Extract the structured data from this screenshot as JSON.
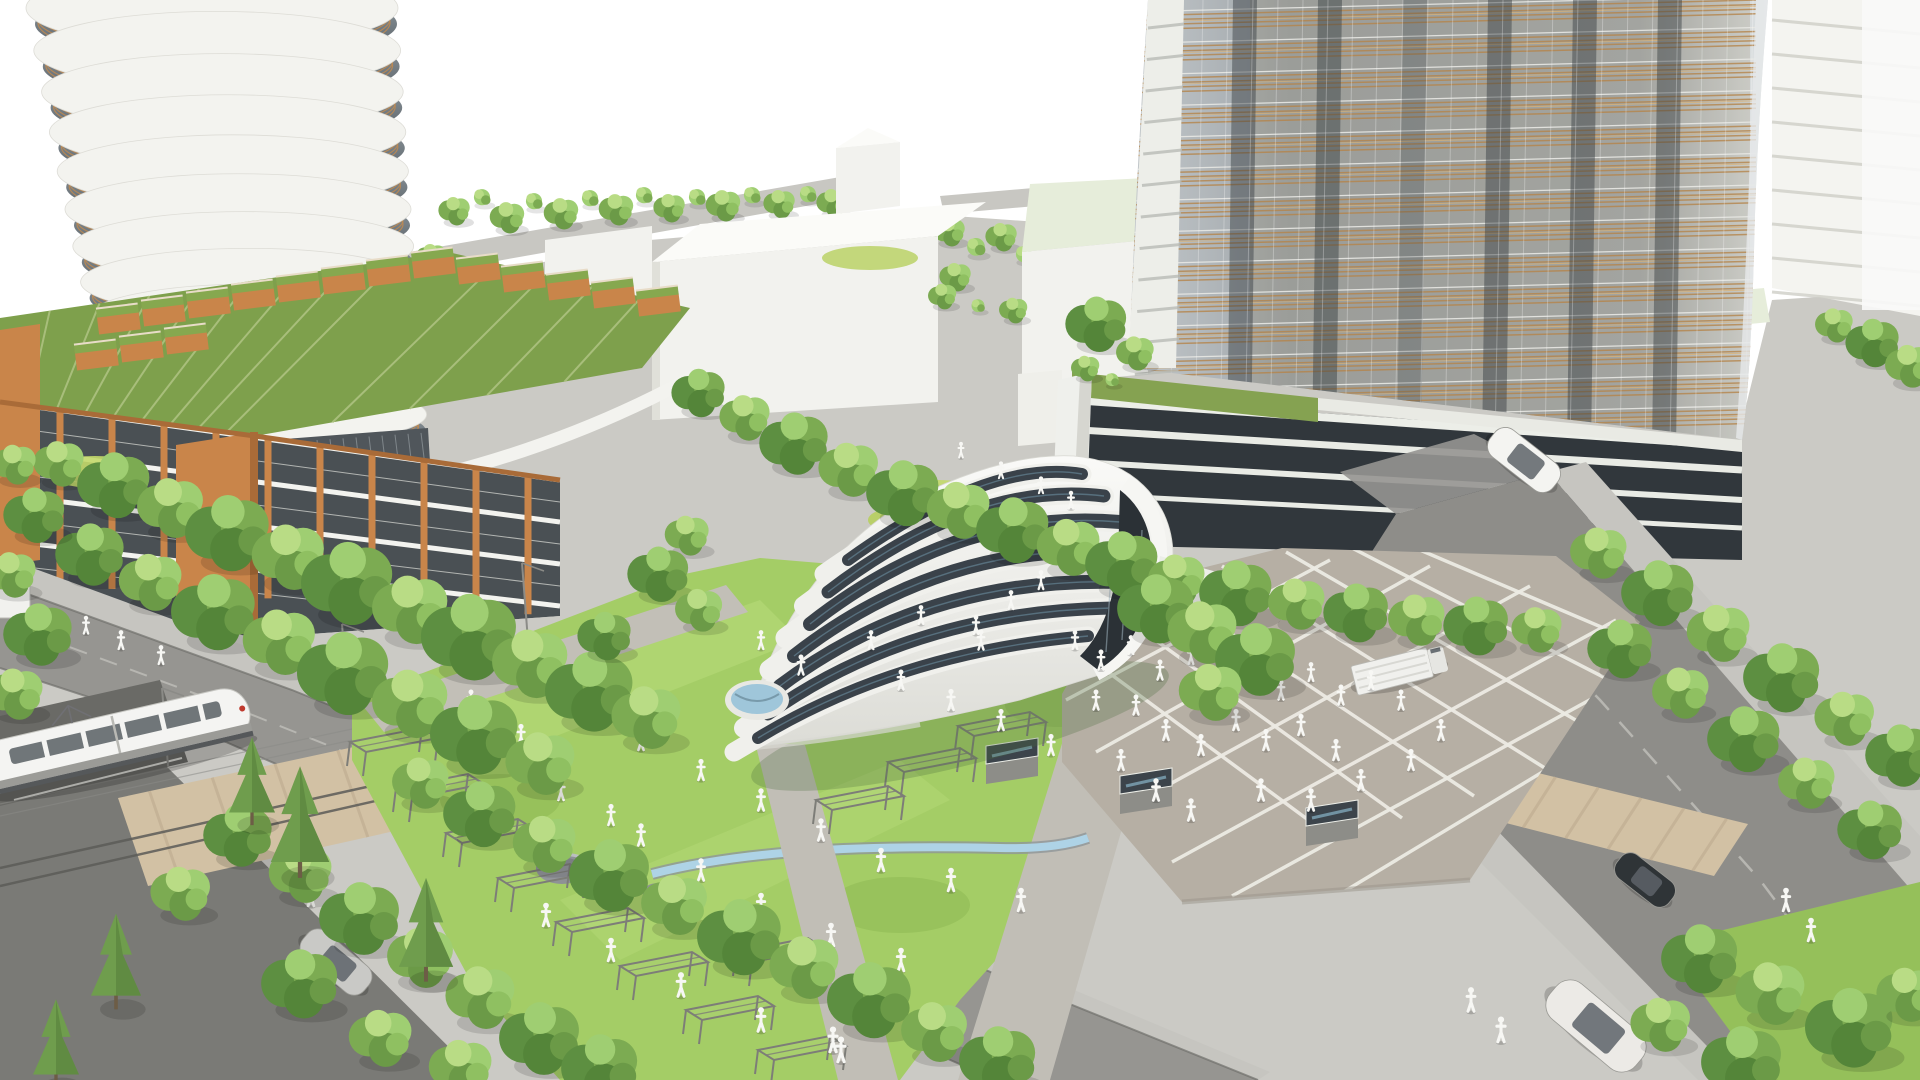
{
  "palette": {
    "bg": "#ffffff",
    "ground": "#cbcac5",
    "sidewalk": "#c6c5c0",
    "road": "#969591",
    "road_dark": "#7a7a76",
    "curb": "#6f6f6b",
    "tan": "#d2c1a4",
    "tan2": "#c2b094",
    "plaza": "#b6afa4",
    "grid": "#edebe4",
    "lawn": "#a4cd66",
    "lawn_light": "#b8dc7a",
    "lawn_dark": "#8ab550",
    "lawn_low": "#95c05a",
    "tree1": "#9fce72",
    "tree2": "#7cab52",
    "tree3": "#5d8f41",
    "tree4": "#b9dc85",
    "conifer": "#6f9d4d",
    "conifer_dark": "#567f3c",
    "trunk": "#7a6a52",
    "shell": "#f4f4f1",
    "shell_shade": "#d9d9d3",
    "panel": "#3a424a",
    "panel_lt": "#6f95a8",
    "arch_dark": "#2b3136",
    "pool": "#9fc6da",
    "water": "#aed3e6",
    "glassL1": "#9aa3a9",
    "glassL2": "#525a60",
    "slab": "#f3f3ef",
    "copper": "#c08a50",
    "terra": "#c9854a",
    "terra_dark": "#a96b38",
    "roofgreen": "#7ea04c",
    "roofseam": "#b3c687",
    "white_bldg": "#f2f2ee",
    "white_top": "#fbfbf8",
    "white_shade": "#e0e0d9",
    "slabline": "#cfcfc8",
    "towerR1": "#b7bcc0",
    "towerR2": "#9aa0a4",
    "louver": "#b5854b",
    "louver_lt": "#dcb273",
    "stripe_dark": "#343a3e",
    "podium_glass": "#31373c",
    "podium_stripe": "#e9ebe5",
    "pale_roof": "#e6edda",
    "fig": "#f7f7f4",
    "wire": "#8b8b87",
    "steel": "#7d7d78",
    "rock": "#8e9196",
    "train_body": "#f4f4f2",
    "train_win": "#646a6f",
    "skylight": "#3c444b",
    "sky_glint": "#7fa6b8",
    "corridor": "#b2b6b4",
    "facade_glass": "#4a5054",
    "terrace": "#85a251",
    "red": "#c03a2e"
  },
  "scene": {
    "left_tower": {
      "floors": 12,
      "cx0": 212,
      "dx": 5.2,
      "cy0": 8,
      "dy": 43,
      "sag": 0.55,
      "rx0": 186,
      "drx": 2.6,
      "ry0": 40,
      "dry": 0.9,
      "rails": 3,
      "mullions": 9
    },
    "right_tower": {
      "rows": 14,
      "y0": 10,
      "dyr": 31.5,
      "lines": 4,
      "gap": 4.6,
      "drop": 16,
      "x1": 1128,
      "x2": 1756,
      "stripes": [
        1245,
        1330,
        1415,
        1500,
        1585,
        1670
      ],
      "mullion_step": 25,
      "fin_x": 1148,
      "fin_w": 36,
      "fin_h": 368
    },
    "podium_stripes": [
      [
        1080,
        430,
        1742,
        470,
        7
      ],
      [
        1078,
        462,
        1742,
        500,
        6
      ],
      [
        1076,
        494,
        1742,
        528,
        5
      ]
    ],
    "plaza_grid_a": [
      [
        1078,
        650,
        1330,
        836
      ],
      [
        1122,
        616,
        1402,
        818
      ],
      [
        1166,
        590,
        1474,
        796
      ],
      [
        1222,
        566,
        1548,
        770
      ],
      [
        1286,
        552,
        1610,
        740
      ],
      [
        1352,
        548,
        1648,
        700
      ],
      [
        1420,
        550,
        1660,
        652
      ]
    ],
    "plaza_grid_b": [
      [
        1066,
        700,
        1330,
        560
      ],
      [
        1096,
        752,
        1430,
        566
      ],
      [
        1130,
        806,
        1530,
        586
      ],
      [
        1172,
        862,
        1616,
        620
      ],
      [
        1232,
        896,
        1648,
        668
      ],
      [
        1330,
        900,
        1662,
        700
      ]
    ],
    "skylights": [
      [
        1012,
        758
      ],
      [
        1146,
        788
      ],
      [
        1332,
        820
      ]
    ],
    "solar_bands": [
      [
        758,
        738,
        900,
        652,
        1088,
        636,
        12
      ],
      [
        768,
        714,
        912,
        612,
        1112,
        608,
        13
      ],
      [
        780,
        686,
        926,
        576,
        1124,
        582,
        14
      ],
      [
        794,
        656,
        942,
        540,
        1128,
        552,
        14
      ],
      [
        810,
        624,
        958,
        508,
        1120,
        522,
        14
      ],
      [
        828,
        592,
        974,
        480,
        1104,
        496,
        13
      ],
      [
        848,
        560,
        990,
        458,
        1082,
        474,
        12
      ]
    ],
    "pergolas": [
      [
        392,
        742
      ],
      [
        438,
        788
      ],
      [
        488,
        833
      ],
      [
        540,
        878
      ],
      [
        598,
        922
      ],
      [
        662,
        966
      ],
      [
        728,
        1010
      ],
      [
        800,
        1050
      ],
      [
        876,
        645
      ],
      [
        938,
        684
      ],
      [
        1000,
        726
      ],
      [
        930,
        762
      ],
      [
        858,
        800
      ],
      [
        778,
        952
      ]
    ],
    "planters": [
      [
        118,
        316
      ],
      [
        163,
        308
      ],
      [
        208,
        300
      ],
      [
        253,
        292
      ],
      [
        298,
        284
      ],
      [
        343,
        276
      ],
      [
        388,
        268
      ],
      [
        433,
        260
      ],
      [
        96,
        352
      ],
      [
        141,
        344
      ],
      [
        186,
        336
      ],
      [
        478,
        266
      ],
      [
        523,
        274
      ],
      [
        568,
        282
      ],
      [
        613,
        290
      ],
      [
        658,
        298
      ]
    ],
    "catenary_poles": [
      [
        168,
        766
      ],
      [
        348,
        702
      ],
      [
        528,
        641
      ]
    ],
    "trees_back": [
      [
        455,
        215,
        0.5,
        "a"
      ],
      [
        482,
        200,
        0.5,
        "d"
      ],
      [
        508,
        222,
        0.55,
        "a"
      ],
      [
        534,
        204,
        0.5,
        "d"
      ],
      [
        562,
        218,
        0.55,
        "a"
      ],
      [
        590,
        201,
        0.5,
        "d"
      ],
      [
        617,
        214,
        0.55,
        "a"
      ],
      [
        644,
        198,
        0.5,
        "d"
      ],
      [
        670,
        212,
        0.5,
        "a"
      ],
      [
        697,
        200,
        0.5,
        "d"
      ],
      [
        724,
        210,
        0.55,
        "a"
      ],
      [
        752,
        198,
        0.5,
        "d"
      ],
      [
        780,
        208,
        0.5,
        "a"
      ],
      [
        808,
        197,
        0.5,
        "d"
      ],
      [
        833,
        207,
        0.5,
        "a"
      ],
      [
        950,
        236,
        0.5,
        "a"
      ],
      [
        976,
        250,
        0.55,
        "d"
      ],
      [
        1002,
        241,
        0.5,
        "a"
      ],
      [
        1024,
        257,
        0.5,
        "d"
      ],
      [
        956,
        281,
        0.5,
        "a"
      ],
      [
        432,
        262,
        0.5,
        "a"
      ],
      [
        452,
        283,
        0.55,
        "d"
      ],
      [
        420,
        294,
        0.5,
        "a"
      ]
    ],
    "trees": [
      [
        1098,
        330,
        0.8,
        "b"
      ],
      [
        1136,
        358,
        0.6,
        "a"
      ],
      [
        1086,
        372,
        0.45,
        "a"
      ],
      [
        1112,
        382,
        0.4,
        "d"
      ],
      [
        943,
        300,
        0.45,
        "a"
      ],
      [
        978,
        308,
        0.4,
        "d"
      ],
      [
        1014,
        314,
        0.45,
        "a"
      ],
      [
        700,
        398,
        0.7,
        "b"
      ],
      [
        746,
        424,
        0.8,
        "a"
      ],
      [
        796,
        450,
        0.9,
        "b"
      ],
      [
        850,
        477,
        0.95,
        "a"
      ],
      [
        905,
        500,
        0.95,
        "b"
      ],
      [
        960,
        518,
        1,
        "a"
      ],
      [
        1015,
        537,
        0.95,
        "b"
      ],
      [
        1070,
        555,
        1,
        "a"
      ],
      [
        1124,
        571,
        0.95,
        "b"
      ],
      [
        1178,
        587,
        0.9,
        "a"
      ],
      [
        1238,
        600,
        0.95,
        "b"
      ],
      [
        1298,
        611,
        0.9,
        "a"
      ],
      [
        1358,
        619,
        0.85,
        "b"
      ],
      [
        1418,
        627,
        0.9,
        "a"
      ],
      [
        1478,
        632,
        0.85,
        "b"
      ],
      [
        1538,
        636,
        0.8,
        "a"
      ],
      [
        60,
        470,
        0.8,
        "a"
      ],
      [
        116,
        492,
        0.95,
        "b"
      ],
      [
        172,
        516,
        1.05,
        "a"
      ],
      [
        230,
        541,
        1.1,
        "b"
      ],
      [
        290,
        566,
        1.15,
        "a"
      ],
      [
        350,
        592,
        1.2,
        "b"
      ],
      [
        412,
        619,
        1.2,
        "a"
      ],
      [
        472,
        646,
        1.25,
        "b"
      ],
      [
        532,
        673,
        1.2,
        "a"
      ],
      [
        592,
        700,
        1.15,
        "b"
      ],
      [
        648,
        726,
        1.1,
        "a"
      ],
      [
        92,
        561,
        0.9,
        "b"
      ],
      [
        152,
        590,
        1,
        "a"
      ],
      [
        216,
        620,
        1.1,
        "b"
      ],
      [
        281,
        651,
        1.15,
        "a"
      ],
      [
        346,
        682,
        1.2,
        "b"
      ],
      [
        412,
        713,
        1.2,
        "a"
      ],
      [
        477,
        743,
        1.15,
        "b"
      ],
      [
        542,
        772,
        1.1,
        "a"
      ],
      [
        688,
        541,
        0.7,
        "a"
      ],
      [
        660,
        580,
        0.8,
        "b"
      ],
      [
        700,
        616,
        0.75,
        "a"
      ],
      [
        606,
        641,
        0.7,
        "b"
      ],
      [
        1158,
        616,
        1,
        "b"
      ],
      [
        1204,
        641,
        1.1,
        "a"
      ],
      [
        1258,
        667,
        1.05,
        "b"
      ],
      [
        1212,
        700,
        1,
        "a"
      ],
      [
        1600,
        560,
        0.9,
        "a"
      ],
      [
        1660,
        600,
        0.95,
        "b"
      ],
      [
        1720,
        641,
        1,
        "a"
      ],
      [
        1784,
        685,
        1,
        "b"
      ],
      [
        1846,
        726,
        0.95,
        "a"
      ],
      [
        1902,
        762,
        0.9,
        "b"
      ],
      [
        1622,
        655,
        0.85,
        "b"
      ],
      [
        1682,
        700,
        0.9,
        "a"
      ],
      [
        1746,
        746,
        0.95,
        "b"
      ],
      [
        1808,
        790,
        0.9,
        "a"
      ],
      [
        1872,
        836,
        0.85,
        "b"
      ],
      [
        1835,
        330,
        0.6,
        "a"
      ],
      [
        1874,
        348,
        0.7,
        "b"
      ],
      [
        1910,
        372,
        0.75,
        "a"
      ],
      [
        1702,
        966,
        1,
        "b"
      ],
      [
        1772,
        1002,
        1.1,
        "a"
      ],
      [
        1852,
        1036,
        1.15,
        "b"
      ],
      [
        1908,
        1002,
        0.95,
        "a"
      ],
      [
        1662,
        1032,
        0.95,
        "a"
      ],
      [
        1744,
        1070,
        1.05,
        "b"
      ],
      [
        422,
        790,
        0.9,
        "a"
      ],
      [
        482,
        821,
        0.95,
        "b"
      ],
      [
        546,
        852,
        1,
        "a"
      ],
      [
        612,
        883,
        1.05,
        "b"
      ],
      [
        676,
        913,
        1.05,
        "a"
      ],
      [
        742,
        945,
        1.1,
        "b"
      ],
      [
        806,
        976,
        1.1,
        "a"
      ],
      [
        872,
        1008,
        1.1,
        "b"
      ],
      [
        936,
        1040,
        1.05,
        "a"
      ],
      [
        1000,
        1068,
        1,
        "b"
      ],
      [
        240,
        842,
        0.9,
        "b"
      ],
      [
        302,
        882,
        1,
        "a"
      ],
      [
        182,
        901,
        0.95,
        "a"
      ],
      [
        362,
        926,
        1.05,
        "b"
      ],
      [
        422,
        966,
        1.05,
        "a"
      ],
      [
        302,
        991,
        1,
        "b"
      ],
      [
        482,
        1006,
        1.1,
        "a"
      ],
      [
        382,
        1046,
        1,
        "a"
      ],
      [
        542,
        1046,
        1.05,
        "b"
      ],
      [
        462,
        1076,
        1,
        "a"
      ],
      [
        602,
        1076,
        1,
        "b"
      ],
      [
        300,
        846,
        1.4,
        "c"
      ],
      [
        426,
        952,
        1.3,
        "c"
      ],
      [
        116,
        982,
        1.2,
        "c"
      ],
      [
        56,
        1062,
        1.1,
        "c"
      ],
      [
        252,
        800,
        1.1,
        "c"
      ],
      [
        15,
        470,
        0.7,
        "a"
      ],
      [
        36,
        521,
        0.8,
        "b"
      ],
      [
        12,
        581,
        0.8,
        "a"
      ],
      [
        40,
        641,
        0.9,
        "b"
      ],
      [
        16,
        701,
        0.9,
        "a"
      ]
    ],
    "people": [
      [
        1075,
        641,
        0.9
      ],
      [
        1101,
        661,
        0.95
      ],
      [
        1131,
        646,
        0.9
      ],
      [
        1160,
        671,
        0.95
      ],
      [
        1191,
        656,
        0.9
      ],
      [
        1221,
        681,
        0.95
      ],
      [
        1251,
        666,
        0.9
      ],
      [
        1281,
        691,
        0.95
      ],
      [
        1311,
        673,
        0.9
      ],
      [
        1341,
        696,
        0.95
      ],
      [
        1371,
        681,
        0.9
      ],
      [
        1401,
        701,
        0.95
      ],
      [
        1236,
        721,
        1
      ],
      [
        1266,
        741,
        1
      ],
      [
        1301,
        726,
        1
      ],
      [
        1336,
        751,
        1
      ],
      [
        1136,
        706,
        0.95
      ],
      [
        1166,
        731,
        1
      ],
      [
        1201,
        746,
        1
      ],
      [
        1096,
        701,
        0.95
      ],
      [
        1121,
        761,
        1
      ],
      [
        1156,
        791,
        1.05
      ],
      [
        1191,
        811,
        1.05
      ],
      [
        1261,
        791,
        1.05
      ],
      [
        1311,
        801,
        1.05
      ],
      [
        1361,
        781,
        1
      ],
      [
        1411,
        761,
        1
      ],
      [
        1441,
        731,
        1
      ],
      [
        1011,
        601,
        0.9
      ],
      [
        1041,
        581,
        0.9
      ],
      [
        976,
        626,
        0.9
      ],
      [
        471,
        701,
        0.95
      ],
      [
        521,
        736,
        1
      ],
      [
        581,
        701,
        0.95
      ],
      [
        641,
        741,
        1
      ],
      [
        701,
        771,
        1
      ],
      [
        761,
        801,
        1.05
      ],
      [
        821,
        831,
        1.05
      ],
      [
        881,
        861,
        1.1
      ],
      [
        951,
        881,
        1.1
      ],
      [
        1021,
        901,
        1.1
      ],
      [
        641,
        836,
        1.05
      ],
      [
        701,
        871,
        1.05
      ],
      [
        761,
        906,
        1.1
      ],
      [
        831,
        936,
        1.1
      ],
      [
        901,
        961,
        1.1
      ],
      [
        561,
        791,
        1
      ],
      [
        611,
        816,
        1
      ],
      [
        901,
        681,
        0.95
      ],
      [
        951,
        701,
        1
      ],
      [
        1001,
        721,
        1
      ],
      [
        1051,
        746,
        1
      ],
      [
        871,
        641,
        0.9
      ],
      [
        921,
        616,
        0.9
      ],
      [
        981,
        641,
        0.95
      ],
      [
        761,
        641,
        0.9
      ],
      [
        801,
        666,
        0.95
      ],
      [
        546,
        916,
        1.1
      ],
      [
        611,
        951,
        1.1
      ],
      [
        681,
        986,
        1.15
      ],
      [
        761,
        1021,
        1.15
      ],
      [
        841,
        1051,
        1.2
      ],
      [
        833,
        1041,
        1.2
      ],
      [
        861,
        991,
        1.15
      ],
      [
        291,
        856,
        1.05
      ],
      [
        311,
        896,
        1.1
      ],
      [
        1001,
        471,
        0.8
      ],
      [
        1041,
        486,
        0.8
      ],
      [
        1071,
        501,
        0.85
      ],
      [
        961,
        451,
        0.75
      ],
      [
        1471,
        1001,
        1.15
      ],
      [
        1501,
        1031,
        1.2
      ],
      [
        1786,
        901,
        1.1
      ],
      [
        1811,
        931,
        1.1
      ],
      [
        121,
        641,
        0.9
      ],
      [
        161,
        656,
        0.9
      ],
      [
        86,
        626,
        0.85
      ],
      [
        1087,
        537,
        0.8
      ]
    ],
    "cars": [
      {
        "x": 1524,
        "y": 460,
        "a": 38,
        "len": 80,
        "w": 34,
        "c": "#f4f4f1"
      },
      {
        "x": 1596,
        "y": 1026,
        "a": 40,
        "len": 112,
        "w": 46,
        "c": "#eceae6"
      },
      {
        "x": 336,
        "y": 962,
        "a": 40,
        "len": 80,
        "w": 34,
        "c": "#c9c9c6"
      },
      {
        "x": 1645,
        "y": 880,
        "a": 38,
        "len": 66,
        "w": 30,
        "c": "#2f3437"
      }
    ],
    "truck": {
      "x": 1398,
      "y": 670,
      "a": -14
    },
    "train": {
      "x": 2,
      "y": 766,
      "a": -13
    }
  }
}
